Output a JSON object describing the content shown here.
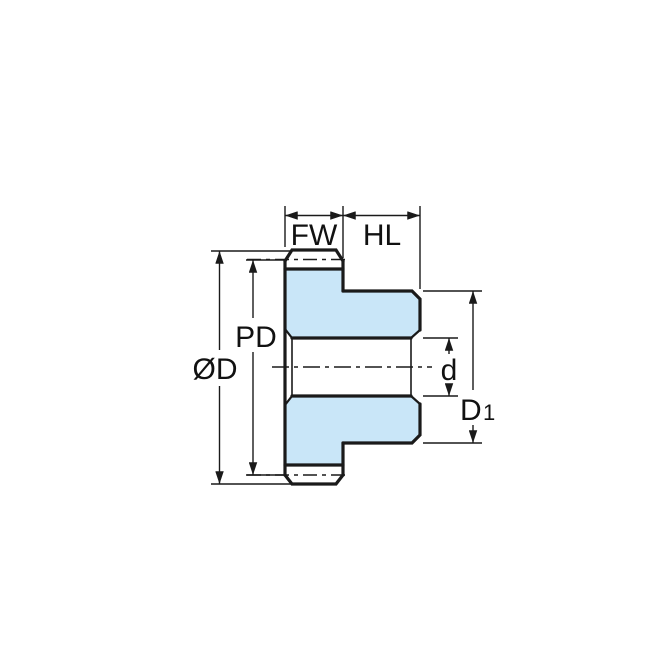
{
  "drawing": {
    "title": "spur-gear-cross-section",
    "labels": {
      "face_width": "FW",
      "hub_length": "HL",
      "pitch_diameter": "PD",
      "outside_diameter": "ØD",
      "bore_diameter": "d",
      "hub_diameter_main": "D",
      "hub_diameter_sub": "1"
    },
    "colors": {
      "body_fill": "#C9E6F8",
      "line": "#1A1A1A",
      "dim_line": "#1A1A1A",
      "background": "#FFFFFF"
    }
  }
}
